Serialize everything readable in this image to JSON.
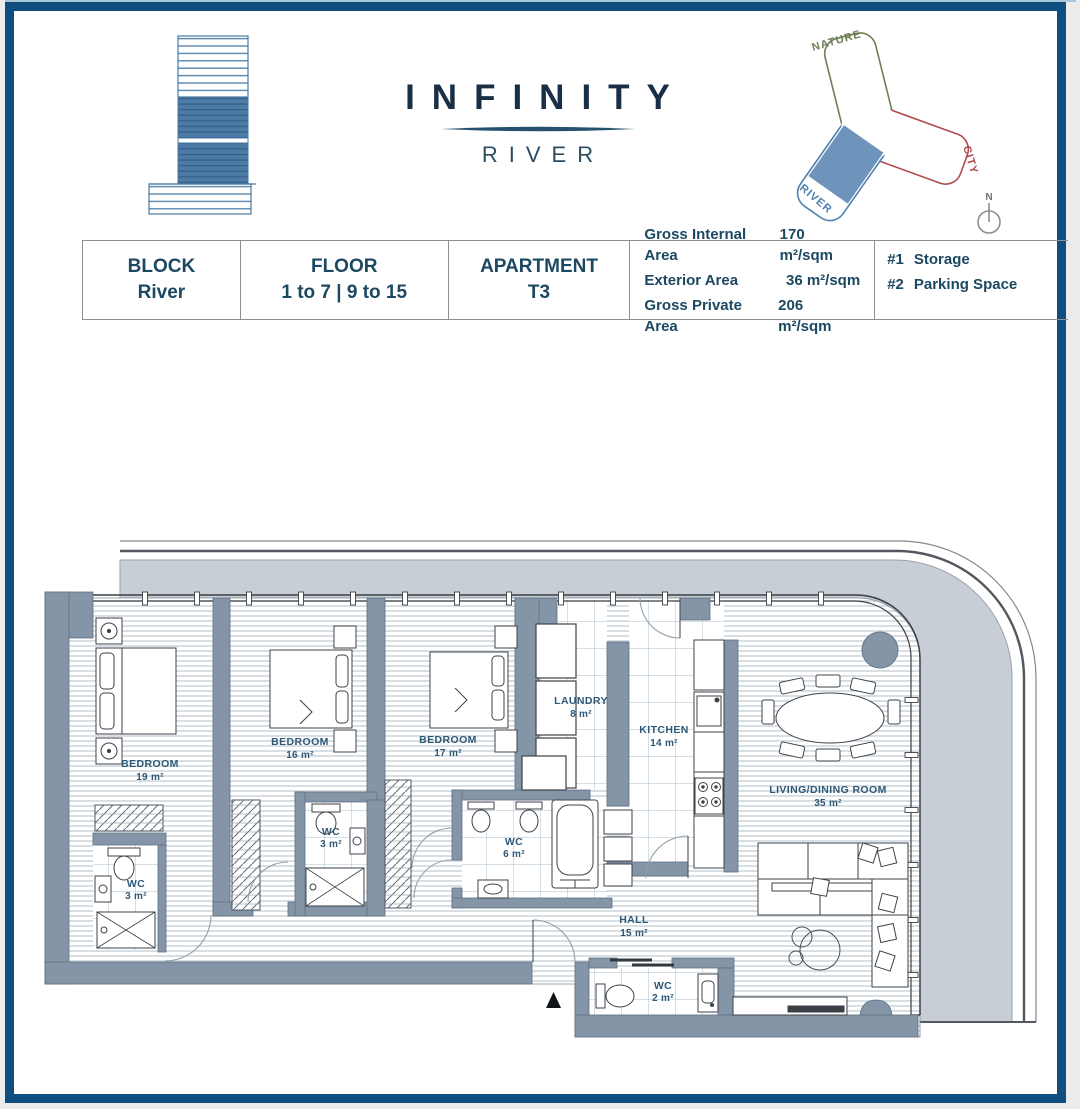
{
  "brand": {
    "title": "INFINITY",
    "subtitle": "RIVER"
  },
  "site_diagram": {
    "wings": [
      {
        "label": "NATURE",
        "color": "#6d7f55"
      },
      {
        "label": "CITY",
        "color": "#b04a50"
      },
      {
        "label": "RIVER",
        "color": "#4f7fae"
      }
    ],
    "highlight_color": "#6e94bc",
    "compass_label": "N"
  },
  "info_table": {
    "cells": [
      {
        "label": "BLOCK",
        "value": "River"
      },
      {
        "label": "FLOOR",
        "value": "1 to 7 | 9 to 15"
      },
      {
        "label": "APARTMENT",
        "value": "T3"
      }
    ],
    "areas": [
      {
        "label": "Gross Internal Area",
        "value": "170 m²/sqm"
      },
      {
        "label": "Exterior Area",
        "value": "36 m²/sqm"
      },
      {
        "label": "Gross Private Area",
        "value": "206 m²/sqm"
      }
    ],
    "extras": [
      {
        "num": "#1",
        "label": "Storage"
      },
      {
        "num": "#2",
        "label": "Parking Space"
      }
    ]
  },
  "floor_plan": {
    "rooms": [
      {
        "name": "BEDROOM",
        "area": "19 m²"
      },
      {
        "name": "BEDROOM",
        "area": "16 m²"
      },
      {
        "name": "BEDROOM",
        "area": "17 m²"
      },
      {
        "name": "LAUNDRY",
        "area": "8 m²"
      },
      {
        "name": "KITCHEN",
        "area": "14 m²"
      },
      {
        "name": "LIVING/DINING ROOM",
        "area": "35 m²"
      },
      {
        "name": "WC",
        "area": "3 m²"
      },
      {
        "name": "WC",
        "area": "3 m²"
      },
      {
        "name": "WC",
        "area": "6 m²"
      },
      {
        "name": "WC",
        "area": "2 m²"
      },
      {
        "name": "HALL",
        "area": "15 m²"
      }
    ],
    "colors": {
      "wall": "#8495a8",
      "terrace": "#c7ced6",
      "label": "#2d5876",
      "border": "#0f4e7e"
    }
  }
}
